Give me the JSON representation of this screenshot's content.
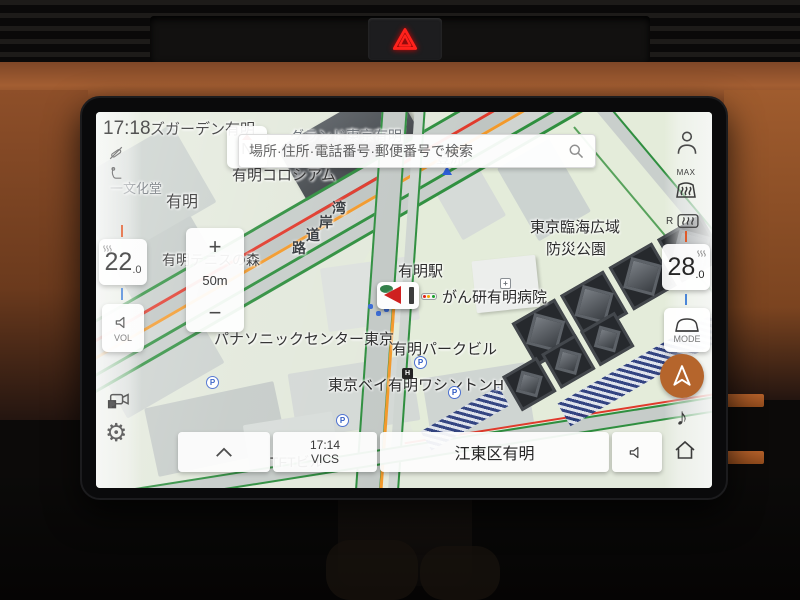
{
  "screen": {
    "status": {
      "clock": "17:18"
    },
    "compass": {
      "north": "N"
    },
    "search": {
      "placeholder": "場所·住所·電話番号·郵便番号で検索"
    },
    "zoom_control": {
      "zoom_in": "+",
      "scale": "50m",
      "zoom_out": "−"
    },
    "climate": {
      "left_temp": {
        "value": "22",
        "decimal": ".0"
      },
      "right_temp": {
        "value": "28",
        "decimal": ".0"
      },
      "volume_label": "VOL",
      "mode_label": "MODE",
      "max_label": "MAX",
      "rear_label": "R"
    },
    "bottom_bar": {
      "vics_time": "17:14",
      "vics_label": "VICS",
      "location": "江東区有明"
    },
    "map": {
      "labels": [
        {
          "text": "ズガーデン有明"
        },
        {
          "text": "グランド東京有明"
        },
        {
          "text": "有明コロシアム"
        },
        {
          "text": "有明"
        },
        {
          "text": "一文化堂"
        },
        {
          "text": "豊洲"
        },
        {
          "text": "東京臨海広域"
        },
        {
          "text": "防災公園"
        },
        {
          "text": "有明テニスの森"
        },
        {
          "text": "有明駅"
        },
        {
          "text": "がん研有明病院"
        },
        {
          "text": "パナソニックセンター東京"
        },
        {
          "text": "有明パークビル"
        },
        {
          "text": "東京ベイ有明ワシントンH"
        },
        {
          "text": "TFTビル"
        }
      ],
      "road_label": [
        "湾",
        "岸",
        "道",
        "路"
      ],
      "parking_letter": "P",
      "hotel_letter": "H",
      "hospital_cross": "+"
    }
  },
  "icons": {
    "hazard": "warning-triangle",
    "compass": "north-up",
    "search": "magnifier",
    "phone": "phone-disconnected",
    "seat": "driver-seat",
    "volume": "speaker",
    "camera": "parking-camera",
    "settings": "gear",
    "profile": "person",
    "defrost_front": "windshield-max-defrost",
    "defrost_rear": "rear-window-defrost",
    "drive_mode": "car",
    "navigation": "nav-arrow",
    "media": "music-note",
    "home": "house",
    "collapse": "chevron-up",
    "mute": "speaker",
    "vehicle_marker": "land-rover-arrow"
  },
  "colors": {
    "accent_copper": "#b5652c",
    "traffic_green": "#2f8f3f",
    "traffic_red": "#e03a2c",
    "traffic_orange": "#f2992b",
    "map_base": "#e3e9dc",
    "hazard_red": "#ff221c"
  }
}
